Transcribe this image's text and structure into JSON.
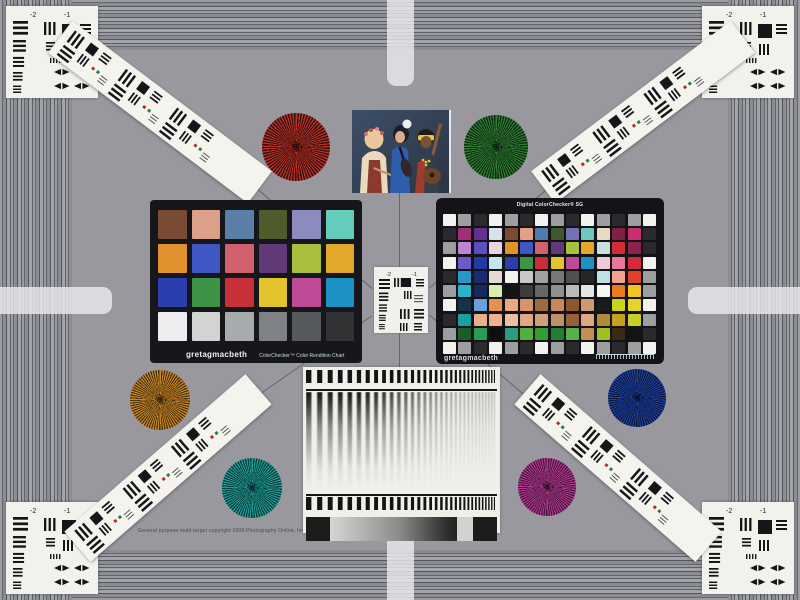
{
  "page": {
    "background": "#98989e",
    "frame_stripe_light": "#a2a4aa",
    "frame_stripe_mid": "#8b8d93",
    "frame_stripe_dark": "#54565e",
    "marker_bar_color": "rgba(233,233,239,0.82)"
  },
  "photo": {
    "description": "three musicians portrait test photo"
  },
  "classic_checker": {
    "brand": "gretagmacbeth",
    "label": "ColorChecker™ Color Rendition Chart",
    "patches": [
      "#7a4b35",
      "#dba188",
      "#5b7fa6",
      "#4e5c2b",
      "#8b8bc0",
      "#64ccba",
      "#e0922f",
      "#3f57c4",
      "#d25f6e",
      "#633a78",
      "#a9c03e",
      "#e2a82c",
      "#2a3fad",
      "#3d9446",
      "#c92f38",
      "#e2c52d",
      "#bf4a97",
      "#1e93c3",
      "#eeeef0",
      "#d2d4d4",
      "#a8abac",
      "#7e8284",
      "#565a5c",
      "#303234"
    ]
  },
  "sg_checker": {
    "title": "Digital ColorChecker® SG",
    "brand": "gretagmacbeth",
    "patches": [
      [
        "#f2f2ee",
        "#9c9ea0",
        "#2a2a2c",
        "#f2f2ee",
        "#9c9ea0",
        "#2a2a2c",
        "#f2f2ee",
        "#9c9ea0",
        "#2a2a2c",
        "#f2f2ee",
        "#9c9ea0",
        "#2a2a2c",
        "#9c9ea0",
        "#f2f2ee"
      ],
      [
        "#2a2a2c",
        "#9e2f78",
        "#63308e",
        "#d9e4ea",
        "#7a4b31",
        "#e3a087",
        "#527cae",
        "#41582b",
        "#7272b4",
        "#6cc7bd",
        "#ead9c4",
        "#7c2140",
        "#c92f70",
        "#2a2a2c"
      ],
      [
        "#9c9ea0",
        "#c082d2",
        "#5a50c0",
        "#ecd2de",
        "#e0922f",
        "#3f57c4",
        "#d25f6e",
        "#633a78",
        "#a9c03e",
        "#e2a82c",
        "#c5e1dc",
        "#d22c34",
        "#8c2450",
        "#2a2a2c"
      ],
      [
        "#f2f2ee",
        "#6a5acc",
        "#1e3ca8",
        "#c4e4e8",
        "#2a3fad",
        "#3d9446",
        "#c92f38",
        "#e2c52d",
        "#bf4a97",
        "#1e93c3",
        "#f0c8d8",
        "#e87898",
        "#d42a3c",
        "#f2f2ee"
      ],
      [
        "#2a2a2c",
        "#2498c8",
        "#1c2a6e",
        "#ead8d4",
        "#f2f2ee",
        "#c8c8c8",
        "#a0a0a0",
        "#787878",
        "#505050",
        "#262626",
        "#bfe0e4",
        "#f0a38e",
        "#e0422a",
        "#9c9ea0"
      ],
      [
        "#9c9ea0",
        "#28b4cc",
        "#16285e",
        "#dcecac",
        "#141414",
        "#3c3c3c",
        "#666666",
        "#909090",
        "#bababa",
        "#e4e4e4",
        "#f6f6f2",
        "#e87c1a",
        "#f0c422",
        "#9c9ea0"
      ],
      [
        "#f2f2ee",
        "#12334a",
        "#6aa0d8",
        "#e89050",
        "#e8a882",
        "#d89468",
        "#a06a40",
        "#c88858",
        "#8a5830",
        "#d09a70",
        "#1a1a1a",
        "#c8d41e",
        "#e8d426",
        "#f2f2ee"
      ],
      [
        "#2a2a2c",
        "#18a0a0",
        "#e8b088",
        "#f0b090",
        "#e8c0a0",
        "#e0a886",
        "#d0a078",
        "#c09068",
        "#986038",
        "#e0a880",
        "#b08c3a",
        "#c8a020",
        "#c8d028",
        "#9c9ea0"
      ],
      [
        "#9c9ea0",
        "#1a5c2a",
        "#2a9c50",
        "#0e0e10",
        "#2a9c80",
        "#50b040",
        "#30a030",
        "#208030",
        "#58b048",
        "#c09050",
        "#a0c020",
        "#3a2a10",
        "#141414",
        "#2a2a2c"
      ],
      [
        "#f2f2ee",
        "#9c9ea0",
        "#2a2a2c",
        "#f2f2ee",
        "#9c9ea0",
        "#2a2a2c",
        "#f2f2ee",
        "#9c9ea0",
        "#2a2a2c",
        "#f2f2ee",
        "#9c9ea0",
        "#2a2a2c",
        "#9c9ea0",
        "#f2f2ee"
      ]
    ]
  },
  "resolution_targets": {
    "corner_labels": [
      "-2",
      "-1"
    ]
  },
  "stars": [
    {
      "name": "red",
      "main": "#b23228",
      "dark": "#390d0b"
    },
    {
      "name": "green",
      "main": "#2f7d35",
      "dark": "#0d2a0f"
    },
    {
      "name": "amber",
      "main": "#c8872b",
      "dark": "#4a3008"
    },
    {
      "name": "blue",
      "main": "#1f41a2",
      "dark": "#0a1538"
    },
    {
      "name": "teal",
      "main": "#209e9a",
      "dark": "#083a38"
    },
    {
      "name": "magenta",
      "main": "#b43b93",
      "dark": "#46123a"
    }
  ],
  "footer": {
    "copyright": "General purpose multi-target copyright 2009 Photography Online, Inc."
  }
}
